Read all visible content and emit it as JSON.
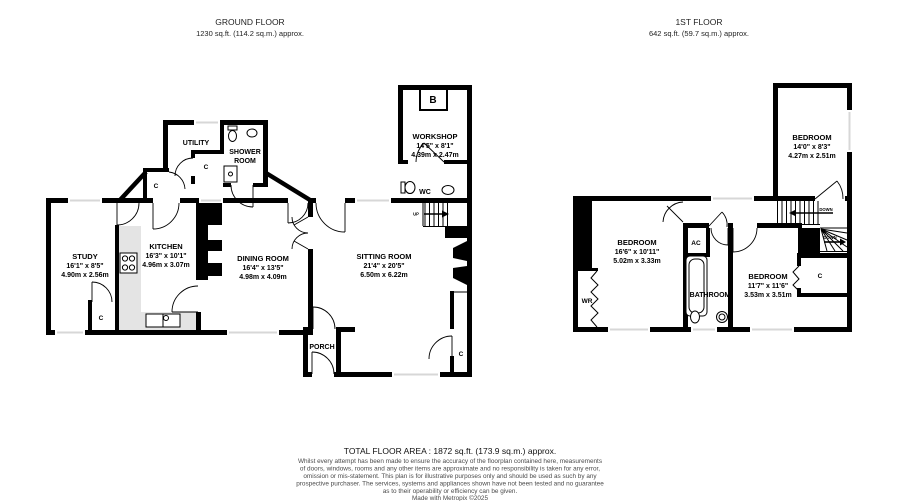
{
  "ground_floor": {
    "title": "GROUND FLOOR",
    "subtitle": "1230 sq.ft. (114.2 sq.m.) approx.",
    "study": {
      "name": "STUDY",
      "imperial": "16'1\" x 8'5\"",
      "metric": "4.90m x 2.56m"
    },
    "kitchen": {
      "name": "KITCHEN",
      "imperial": "16'3\" x 10'1\"",
      "metric": "4.96m x 3.07m"
    },
    "dining_room": {
      "name": "DINING ROOM",
      "imperial": "16'4\" x 13'5\"",
      "metric": "4.98m x 4.09m"
    },
    "sitting_room": {
      "name": "SITTING ROOM",
      "imperial": "21'4\" x 20'5\"",
      "metric": "6.50m x 6.22m"
    },
    "workshop": {
      "name": "WORKSHOP",
      "imperial": "14'5\" x 8'1\"",
      "metric": "4.39m x 2.47m"
    },
    "utility": "UTILITY",
    "shower_room_line1": "SHOWER",
    "shower_room_line2": "ROOM",
    "wc": "WC",
    "porch": "PORCH",
    "up": "UP",
    "boiler": "B",
    "cupboard": "C"
  },
  "first_floor": {
    "title": "1ST FLOOR",
    "subtitle": "642 sq.ft. (59.7 sq.m.) approx.",
    "bedroom_top": {
      "name": "BEDROOM",
      "imperial": "14'0\" x 8'3\"",
      "metric": "4.27m x 2.51m"
    },
    "bedroom_left": {
      "name": "BEDROOM",
      "imperial": "16'6\" x 10'11\"",
      "metric": "5.02m x 3.33m"
    },
    "bedroom_right": {
      "name": "BEDROOM",
      "imperial": "11'7\" x 11'6\"",
      "metric": "3.53m x 3.51m"
    },
    "bathroom": "BATHROOM",
    "airing_cupboard": "AC",
    "wardrobe": "WR",
    "cupboard": "C",
    "down": "DOWN"
  },
  "footer": {
    "total": "TOTAL FLOOR AREA : 1872 sq.ft. (173.9 sq.m.) approx.",
    "line1": "Whilst every attempt has been made to ensure the accuracy of the floorplan contained here, measurements",
    "line2": "of doors, windows, rooms and any other items are approximate and no responsibility is taken for any error,",
    "line3": "omission or mis-statement. This plan is for illustrative purposes only and should be used as such by any",
    "line4": "prospective purchaser. The services, systems and appliances shown have not been tested and no guarantee",
    "line5": "as to their operability or efficiency can be given.",
    "credit": "Made with Metropix ©2025"
  }
}
